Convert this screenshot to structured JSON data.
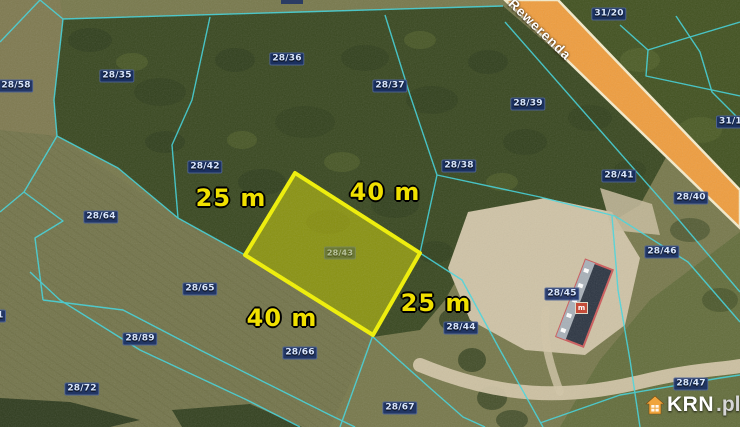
{
  "map": {
    "description": "Aerial cadastral map with highlighted building plot for sale",
    "street": {
      "name": "Rewerenda"
    },
    "highlighted_parcel": {
      "number": "28/43",
      "outline_color": "#f2f200",
      "dimensions": [
        {
          "text": "25 m",
          "side": "top-left"
        },
        {
          "text": "40 m",
          "side": "top-right"
        },
        {
          "text": "25 m",
          "side": "bottom-right"
        },
        {
          "text": "40 m",
          "side": "bottom-left"
        }
      ]
    },
    "parcel_labels": [
      {
        "text": "28/58"
      },
      {
        "text": "28/35"
      },
      {
        "text": "28/36"
      },
      {
        "text": "28/37"
      },
      {
        "text": "31/20"
      },
      {
        "text": "28/39"
      },
      {
        "text": "31/19"
      },
      {
        "text": "28/42"
      },
      {
        "text": "28/38"
      },
      {
        "text": "28/41"
      },
      {
        "text": "28/40"
      },
      {
        "text": "28/46"
      },
      {
        "text": "28/45"
      },
      {
        "text": "28/44"
      },
      {
        "text": "28/47"
      },
      {
        "text": "28/64"
      },
      {
        "text": "28/65"
      },
      {
        "text": "28/89"
      },
      {
        "text": "28/66"
      },
      {
        "text": "28/72"
      },
      {
        "text": "28/67"
      },
      {
        "text": "1"
      }
    ],
    "building_marker": {
      "text": "m"
    },
    "watermark": {
      "brand": "KRN",
      "suffix": ".pl",
      "icon": "house-icon"
    },
    "colors": {
      "road_orange": "#ef9d3e",
      "road_border": "#f6eccb",
      "parcel_line_cyan": "#3fd9e3",
      "highlight_yellow": "#f2f200",
      "dimension_text": "#f0e000",
      "label_background": "#162c68",
      "label_text": "#d9e7ff",
      "watermark_orange": "#f0a43c",
      "forest_green": "#38471f",
      "field_olive": "#77784b",
      "sand": "#cfc3a6"
    }
  }
}
